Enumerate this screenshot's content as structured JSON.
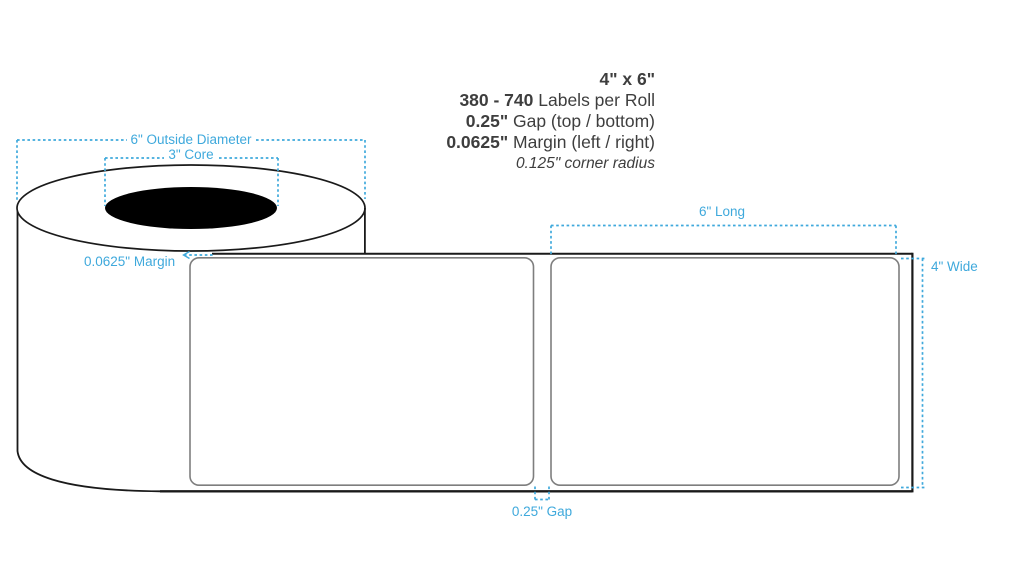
{
  "specs": {
    "size": "4\" x 6\"",
    "labels_per_roll": {
      "value": "380 - 740",
      "text": " Labels per Roll"
    },
    "gap": {
      "value": "0.25\"",
      "text": " Gap (top / bottom)"
    },
    "margin": {
      "value": "0.0625\"",
      "text": " Margin (left / right)"
    },
    "corner_radius": "0.125\" corner radius"
  },
  "annotations": {
    "outside_diameter": "6\" Outside Diameter",
    "core": "3\" Core",
    "margin": "0.0625\" Margin",
    "length": "6\" Long",
    "width": "4\" Wide",
    "gap": "0.25\" Gap"
  },
  "colors": {
    "annotation_blue": "#3FA9DC",
    "spec_text": "#3E3E3E",
    "line_black": "#1A1A1A",
    "label_outline": "#7E7E7E",
    "core_fill": "#000000",
    "background": "#FFFFFF"
  }
}
